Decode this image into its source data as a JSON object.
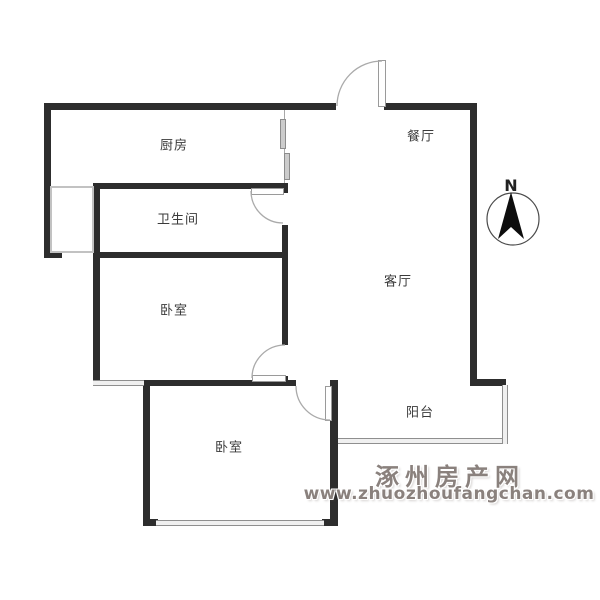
{
  "floorplan": {
    "rooms": {
      "kitchen": {
        "label": "厨房"
      },
      "dining": {
        "label": "餐厅"
      },
      "bathroom": {
        "label": "卫生间"
      },
      "living": {
        "label": "客厅"
      },
      "bedroom_top": {
        "label": "卧室"
      },
      "bedroom_bottom": {
        "label": "卧室"
      },
      "balcony": {
        "label": "阳台"
      }
    },
    "compass": {
      "label": "N"
    },
    "watermark": {
      "site_name": "涿州房产网",
      "site_url": "www.zhuozhoufangchan.com"
    },
    "colors": {
      "wall": "#2d2d2d",
      "door_arc": "#aaaaaa",
      "window_edge": "#8f8f8f",
      "label_text": "#3a3a3a",
      "watermark_gray": "#8a817d",
      "compass_needle": "#0d0d0d"
    }
  }
}
